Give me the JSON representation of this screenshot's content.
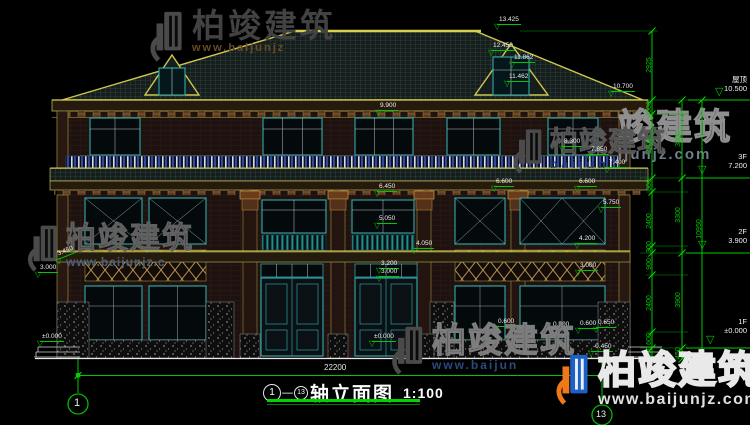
{
  "drawing": {
    "title": {
      "axis_from": "1",
      "separator": "—",
      "axis_to": "13",
      "name": "轴立面图",
      "scale": "1:100"
    },
    "overall_width_dim": "22200",
    "axis_bubbles": {
      "left": "1",
      "right": "13"
    }
  },
  "levels": [
    {
      "label": "屋顶",
      "value": "10.500",
      "y": 76,
      "tx": 715,
      "ty": 87
    },
    {
      "label": "3F",
      "value": "7.200",
      "y": 153,
      "tx": 698,
      "ty": 165
    },
    {
      "label": "2F",
      "value": "3.900",
      "y": 228,
      "tx": 698,
      "ty": 240
    },
    {
      "label": "1F",
      "value": "±0.000",
      "y": 318,
      "tx": 706,
      "ty": 335
    }
  ],
  "vertical_dims": [
    {
      "text": "2925",
      "x": 650,
      "y": 65
    },
    {
      "text": "600",
      "x": 650,
      "y": 107
    },
    {
      "text": "2700",
      "x": 650,
      "y": 146
    },
    {
      "text": "600",
      "x": 650,
      "y": 185
    },
    {
      "text": "2400",
      "x": 650,
      "y": 221
    },
    {
      "text": "300",
      "x": 650,
      "y": 247
    },
    {
      "text": "900",
      "x": 650,
      "y": 264
    },
    {
      "text": "2400",
      "x": 650,
      "y": 303
    },
    {
      "text": "600",
      "x": 650,
      "y": 339
    },
    {
      "text": "450",
      "x": 650,
      "y": 352
    },
    {
      "text": "3300",
      "x": 679,
      "y": 139
    },
    {
      "text": "3300",
      "x": 679,
      "y": 215
    },
    {
      "text": "3900",
      "x": 679,
      "y": 300
    },
    {
      "text": "450",
      "x": 679,
      "y": 353
    },
    {
      "text": "10950",
      "x": 700,
      "y": 229
    }
  ],
  "elevation_markers": [
    {
      "text": "13.425",
      "x": 497,
      "y": 16
    },
    {
      "text": "12.450",
      "x": 491,
      "y": 42
    },
    {
      "text": "11.862",
      "x": 512,
      "y": 54
    },
    {
      "text": "11.462",
      "x": 507,
      "y": 73
    },
    {
      "text": "10.700",
      "x": 611,
      "y": 83
    },
    {
      "text": "9.900",
      "x": 378,
      "y": 102
    },
    {
      "text": "8.300",
      "x": 562,
      "y": 138
    },
    {
      "text": "7.850",
      "x": 589,
      "y": 146
    },
    {
      "text": "7.400",
      "x": 607,
      "y": 159
    },
    {
      "text": "6.600",
      "x": 494,
      "y": 178
    },
    {
      "text": "6.600",
      "x": 577,
      "y": 178
    },
    {
      "text": "6.450",
      "x": 377,
      "y": 183
    },
    {
      "text": "5.750",
      "x": 601,
      "y": 199
    },
    {
      "text": "5.050",
      "x": 377,
      "y": 215
    },
    {
      "text": "4.200",
      "x": 577,
      "y": 235
    },
    {
      "text": "4.050",
      "x": 414,
      "y": 240
    },
    {
      "text": "3.450",
      "x": 58,
      "y": 251,
      "r": -22
    },
    {
      "text": "3.200",
      "x": 379,
      "y": 260
    },
    {
      "text": "3.000",
      "x": 379,
      "y": 268
    },
    {
      "text": "3.000",
      "x": 38,
      "y": 264
    },
    {
      "text": "3.000",
      "x": 578,
      "y": 262
    },
    {
      "text": "0.600",
      "x": 496,
      "y": 318
    },
    {
      "text": "0.500",
      "x": 551,
      "y": 321
    },
    {
      "text": "0.600",
      "x": 578,
      "y": 320
    },
    {
      "text": "0.650",
      "x": 596,
      "y": 319
    },
    {
      "text": "-0.450",
      "x": 591,
      "y": 343
    },
    {
      "text": "±0.000",
      "x": 372,
      "y": 333
    },
    {
      "text": "±0.000",
      "x": 40,
      "y": 333
    }
  ],
  "watermarks": {
    "instances": [
      {
        "brand": "柏竣建筑",
        "url": "www.baijunjz"
      },
      {
        "brand": "竣建筑",
        "url": "ijunjz.com"
      },
      {
        "brand": "柏竣建筑",
        "url": "www.baijunjz.c"
      },
      {
        "brand": "柏竣建筑",
        "url": "baijun"
      },
      {
        "brand": "柏竣建筑",
        "url": "www.baijun"
      },
      {
        "brand": "柏竣建筑",
        "url": "www.baijunjz.com"
      }
    ]
  },
  "colors": {
    "dimension_green": "#00c800",
    "outline_yellow": "#c8c24e",
    "window_teal": "#2f9e9e",
    "logo_blue": "#1e5fc4",
    "logo_orange": "#f07818",
    "background": "#000000"
  }
}
